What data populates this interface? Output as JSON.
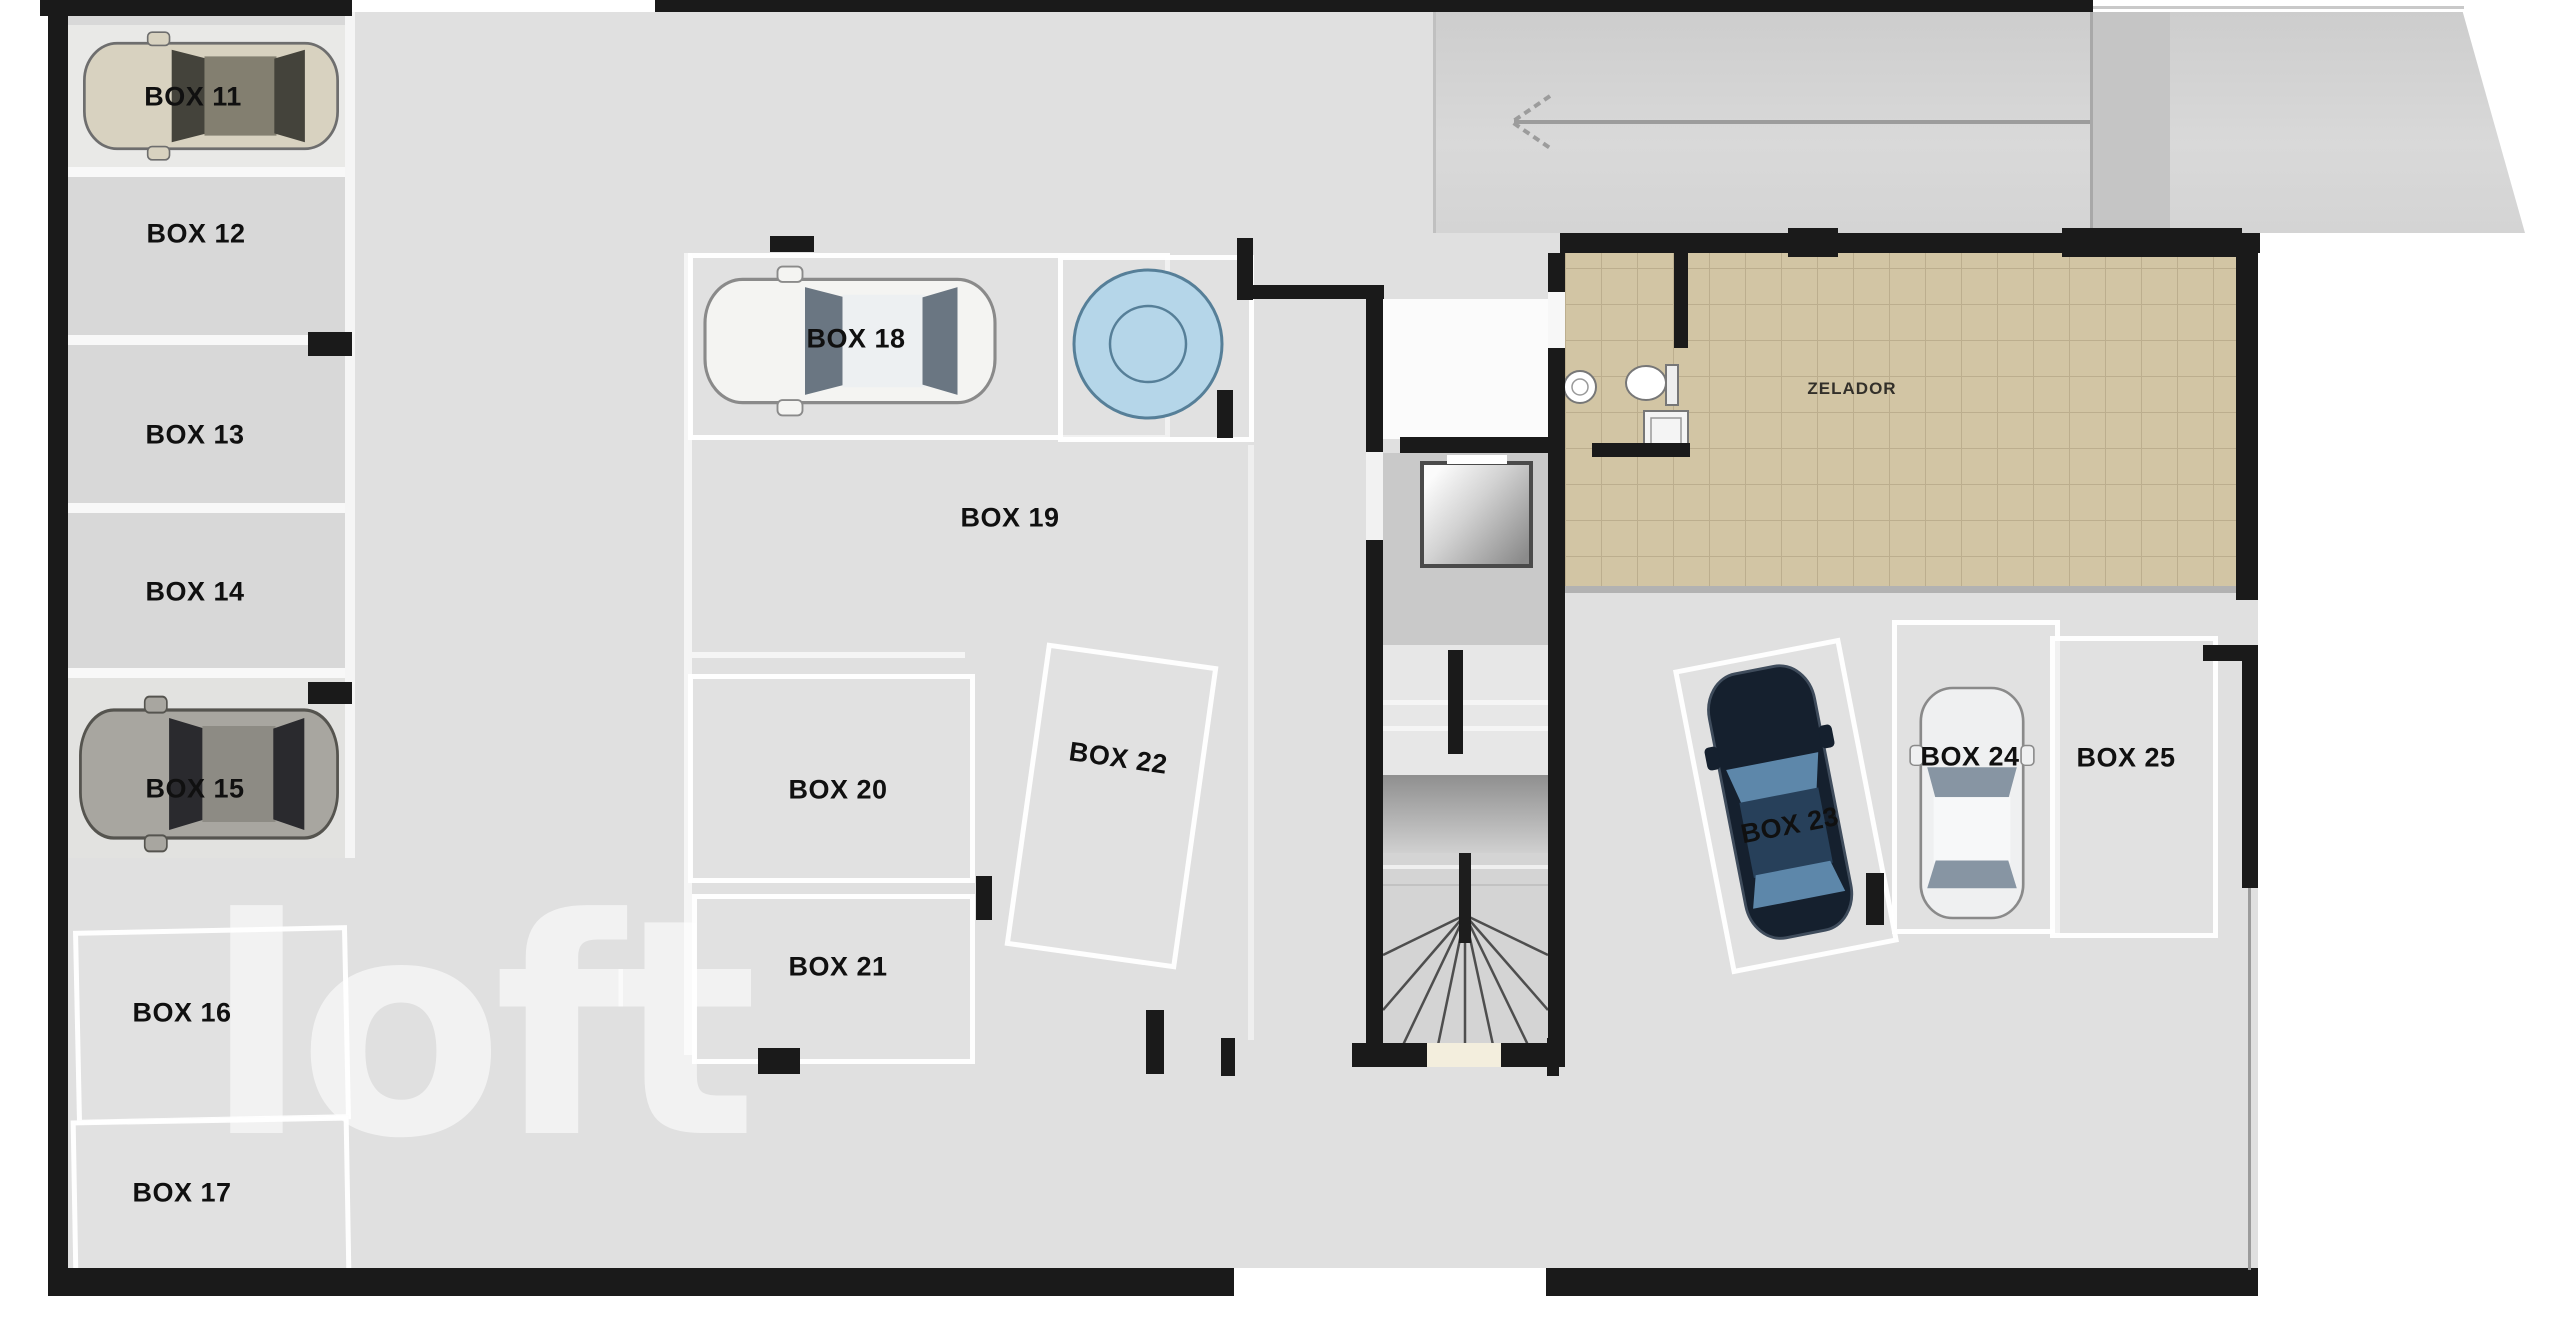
{
  "watermark_text": "loft",
  "zelador_label": "ZELADOR",
  "boxes": {
    "b11": "BOX 11",
    "b12": "BOX 12",
    "b13": "BOX 13",
    "b14": "BOX 14",
    "b15": "BOX 15",
    "b16": "BOX 16",
    "b17": "BOX 17",
    "b18": "BOX 18",
    "b19": "BOX 19",
    "b20": "BOX 20",
    "b21": "BOX 21",
    "b22": "BOX 22",
    "b23": "BOX 23",
    "b24": "BOX 24",
    "b25": "BOX 25"
  },
  "colors": {
    "wall": "#1a1a1a",
    "floor": "#e0e0e0",
    "tile": "#d2c5a4",
    "tile_line": "#bcae8e",
    "turntable_fill": "#b5d6e9",
    "turntable_stroke": "#567f98",
    "arrow": "#9c9c9c"
  },
  "cars": {
    "box11": {
      "body": "#d8d2c0",
      "glass": "#44433b",
      "roof": "#837f70"
    },
    "box15": {
      "body": "#a8a6a0",
      "glass": "#2a2a2e",
      "roof": "#8d8b84"
    },
    "box18": {
      "body": "#f4f4f2",
      "glass": "#6a7682",
      "roof": "#edf0f2"
    },
    "box23": {
      "body": "#15202e",
      "glass": "#5d87aa",
      "roof": "#27405a"
    },
    "box24": {
      "body": "#eff0f1",
      "glass": "#8795a3",
      "roof": "#f7f8f9"
    }
  }
}
